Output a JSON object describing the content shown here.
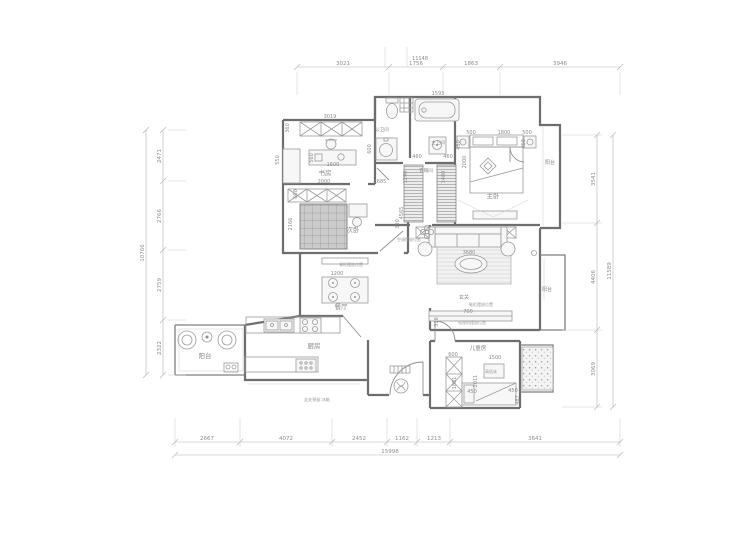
{
  "drawing": {
    "type": "residential floor plan",
    "units": "mm"
  },
  "rooms": [
    {
      "t": "书房",
      "x": 325,
      "y": 175,
      "s": 6.5
    },
    {
      "t": "公卫间",
      "x": 382,
      "y": 131,
      "s": 4.5
    },
    {
      "t": "主卫间",
      "x": 438,
      "y": 144,
      "s": 4.5
    },
    {
      "t": "衣帽间",
      "x": 426,
      "y": 172,
      "s": 4.5
    },
    {
      "t": "主卧",
      "x": 493,
      "y": 198,
      "s": 6.5
    },
    {
      "t": "阳台",
      "x": 550,
      "y": 164,
      "s": 5
    },
    {
      "t": "次卧",
      "x": 353,
      "y": 232,
      "s": 6.5
    },
    {
      "t": "餐厅",
      "x": 341,
      "y": 309,
      "s": 6.5
    },
    {
      "t": "厨房",
      "x": 314,
      "y": 348,
      "s": 6.5
    },
    {
      "t": "阳台",
      "x": 205,
      "y": 358,
      "s": 6.5
    },
    {
      "t": "儿童房",
      "x": 478,
      "y": 350,
      "s": 5.5
    },
    {
      "t": "阳台",
      "x": 547,
      "y": 291,
      "s": 5
    },
    {
      "t": "玄关",
      "x": 464,
      "y": 299,
      "s": 5
    }
  ],
  "notes": [
    {
      "t": "鞋柜摆放位置",
      "x": 481,
      "y": 306,
      "s": 4
    },
    {
      "t": "餐柜摆放位置",
      "x": 351,
      "y": 266,
      "s": 4
    },
    {
      "t": "电视机摆放位置",
      "x": 472,
      "y": 324,
      "s": 4
    },
    {
      "t": "空调摆放位置",
      "x": 409,
      "y": 241,
      "s": 4
    },
    {
      "t": "高低床",
      "x": 491,
      "y": 373,
      "s": 4
    },
    {
      "t": "此处预留:冰箱",
      "x": 317,
      "y": 401,
      "s": 4
    }
  ],
  "inner_dims": [
    {
      "t": "11148",
      "x": 420,
      "y": 60
    },
    {
      "t": "1593",
      "x": 438,
      "y": 95
    },
    {
      "t": "3019",
      "x": 330,
      "y": 118
    },
    {
      "t": "360",
      "x": 289,
      "y": 128,
      "r": 1
    },
    {
      "t": "550",
      "x": 279,
      "y": 160,
      "r": 1
    },
    {
      "t": "560",
      "x": 313,
      "y": 158,
      "r": 1
    },
    {
      "t": "1600",
      "x": 333,
      "y": 166
    },
    {
      "t": "2000",
      "x": 324,
      "y": 183
    },
    {
      "t": "1685",
      "x": 380,
      "y": 183
    },
    {
      "t": "600",
      "x": 297,
      "y": 194,
      "r": 1
    },
    {
      "t": "2166",
      "x": 292,
      "y": 224,
      "r": 1
    },
    {
      "t": "4565",
      "x": 403,
      "y": 213,
      "r": 1
    },
    {
      "t": "300",
      "x": 399,
      "y": 224,
      "r": 1
    },
    {
      "t": "600",
      "x": 371,
      "y": 149,
      "r": 1
    },
    {
      "t": "460",
      "x": 417,
      "y": 158
    },
    {
      "t": "460",
      "x": 448,
      "y": 158
    },
    {
      "t": "1290",
      "x": 407,
      "y": 177,
      "r": 1
    },
    {
      "t": "1480",
      "x": 445,
      "y": 177,
      "r": 1
    },
    {
      "t": "500",
      "x": 471,
      "y": 134
    },
    {
      "t": "1800",
      "x": 504,
      "y": 134
    },
    {
      "t": "500",
      "x": 527,
      "y": 134
    },
    {
      "t": "450",
      "x": 460,
      "y": 145,
      "r": 1
    },
    {
      "t": "450",
      "x": 525,
      "y": 144,
      "r": 1
    },
    {
      "t": "2000",
      "x": 466,
      "y": 162,
      "r": 1
    },
    {
      "t": "3680",
      "x": 469,
      "y": 254
    },
    {
      "t": "1200",
      "x": 337,
      "y": 275
    },
    {
      "t": "700",
      "x": 468,
      "y": 313
    },
    {
      "t": "318",
      "x": 438,
      "y": 322,
      "r": 1
    },
    {
      "t": "600",
      "x": 453,
      "y": 356
    },
    {
      "t": "1500",
      "x": 495,
      "y": 359
    },
    {
      "t": "1881",
      "x": 456,
      "y": 383,
      "r": 1
    },
    {
      "t": "2011",
      "x": 477,
      "y": 381,
      "r": 1
    },
    {
      "t": "450",
      "x": 472,
      "y": 393
    },
    {
      "t": "450",
      "x": 513,
      "y": 392
    },
    {
      "t": "487",
      "x": 519,
      "y": 400,
      "r": 1
    }
  ],
  "dim_chains": [
    {
      "id": "top",
      "orient": "h",
      "pos": 67,
      "from": 297,
      "to": 620,
      "ticks": [
        297,
        389,
        443,
        500,
        620
      ],
      "wFrom": 72,
      "wTo": 95,
      "labels": [
        {
          "t": "3021",
          "at": 343
        },
        {
          "t": "1756",
          "at": 416
        },
        {
          "t": "1863",
          "at": 471
        },
        {
          "t": "3946",
          "at": 560
        }
      ]
    },
    {
      "id": "left",
      "orient": "v",
      "pos": 163,
      "from": 130,
      "to": 375,
      "ticks": [
        130,
        181,
        250,
        320,
        375
      ],
      "wFrom": 168,
      "wTo": 186,
      "labels": [
        {
          "t": "2471",
          "at": 156
        },
        {
          "t": "2766",
          "at": 216
        },
        {
          "t": "2759",
          "at": 285
        },
        {
          "t": "2322",
          "at": 348
        }
      ]
    },
    {
      "id": "left-total",
      "orient": "v",
      "pos": 146,
      "from": 130,
      "to": 375,
      "ticks": [
        130,
        375
      ],
      "wFrom": null,
      "wTo": null,
      "labels": [
        {
          "t": "10766",
          "at": 253
        }
      ]
    },
    {
      "id": "right",
      "orient": "v",
      "pos": 597,
      "from": 135,
      "to": 407,
      "ticks": [
        135,
        223,
        330,
        407
      ],
      "wFrom": 562,
      "wTo": 602,
      "labels": [
        {
          "t": "3541",
          "at": 179
        },
        {
          "t": "4406",
          "at": 277
        },
        {
          "t": "3069",
          "at": 369
        }
      ]
    },
    {
      "id": "right-total",
      "orient": "v",
      "pos": 613,
      "from": 135,
      "to": 407,
      "ticks": [
        135,
        407
      ],
      "wFrom": null,
      "wTo": null,
      "labels": [
        {
          "t": "11589",
          "at": 271
        }
      ]
    },
    {
      "id": "bottom",
      "orient": "h",
      "pos": 442,
      "from": 175,
      "to": 620,
      "ticks": [
        175,
        240,
        332,
        387,
        417,
        450,
        620
      ],
      "wFrom": 418,
      "wTo": 447,
      "labels": [
        {
          "t": "2667",
          "at": 207
        },
        {
          "t": "4072",
          "at": 286
        },
        {
          "t": "2452",
          "at": 359
        },
        {
          "t": "1162",
          "at": 402
        },
        {
          "t": "1213",
          "at": 434
        },
        {
          "t": "3641",
          "at": 535
        }
      ]
    },
    {
      "id": "bottom-total",
      "orient": "h",
      "pos": 455,
      "from": 175,
      "to": 620,
      "ticks": [
        175,
        620
      ],
      "wFrom": null,
      "wTo": null,
      "labels": [
        {
          "t": "15998",
          "at": 390
        }
      ]
    }
  ]
}
